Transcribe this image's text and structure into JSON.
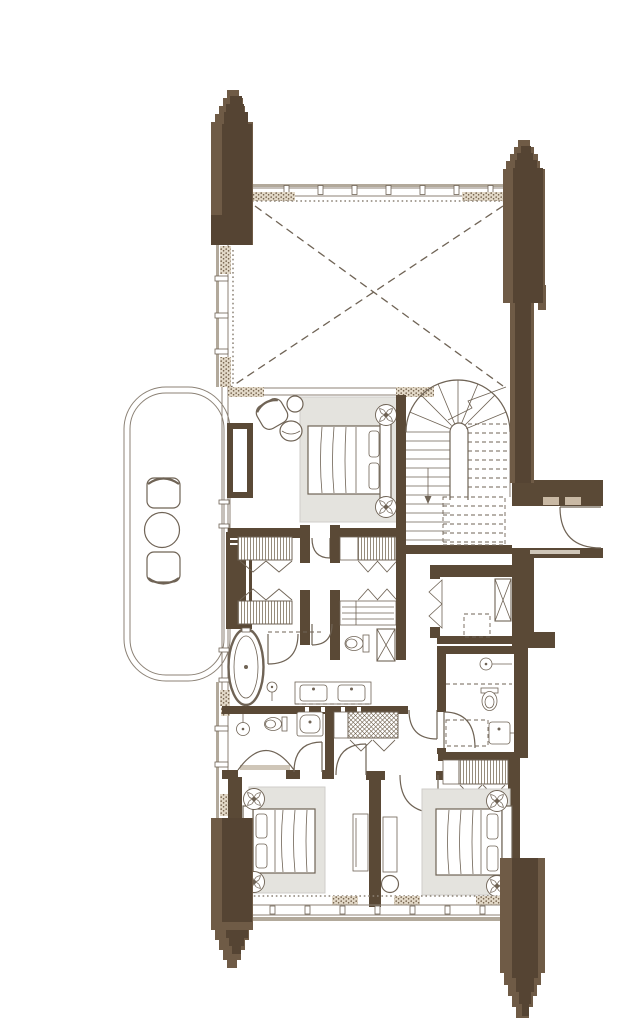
{
  "page": {
    "background": "#ffffff",
    "description": "Architectural floor plan of a residential unit drawn in brown line-work on white; no text labels are rendered on the drawing"
  },
  "colors": {
    "wall": "#5a4936",
    "column_light": "#6f5b46",
    "column_dark": "#554433",
    "line": "#6f6355",
    "line_light": "#8c8276",
    "window_band": "#b2a99b",
    "rug": "#e4e3de",
    "rug_edge": "#cfcec9",
    "inset_light": "#cfc6b8",
    "tick_tan": "#c9b9a4"
  },
  "plan": {
    "columns": [
      "stepped-pylon-top-left",
      "stepped-pylon-top-right",
      "stepped-pylon-bottom-left",
      "stepped-pylon-bottom-right"
    ],
    "rooms": [
      {
        "name": "double-height-void",
        "features": [
          "dashed-cross-diagonals",
          "curtain-wall-glazing"
        ]
      },
      {
        "name": "balcony",
        "features": [
          "lounge-chair",
          "round-table",
          "lounge-chair"
        ]
      },
      {
        "name": "master-bedroom",
        "features": [
          "double-bed",
          "area-rug",
          "flower-side-table",
          "flower-side-table",
          "armchair",
          "ottoman",
          "side-table",
          "tv-console",
          "tall-wardrobe"
        ]
      },
      {
        "name": "staircase",
        "features": [
          "u-stair-with-winders",
          "up-arrow",
          "section-break-line",
          "dashed-upper-flight"
        ]
      },
      {
        "name": "entry-hall",
        "features": [
          "entry-door-swing"
        ]
      },
      {
        "name": "walk-in-closet",
        "features": [
          "hanging-wardrobe",
          "hanging-wardrobe",
          "hanging-wardrobe",
          "shelf-unit"
        ]
      },
      {
        "name": "master-bathroom",
        "features": [
          "freestanding-bathtub",
          "shower-enclosure",
          "hand-shower",
          "double-vanity",
          "toilet",
          "service-shaft"
        ]
      },
      {
        "name": "bathroom-2",
        "features": [
          "curved-shower",
          "shower-head",
          "toilet",
          "vanity-sink"
        ]
      },
      {
        "name": "laundry-closet",
        "features": [
          "bifold-door",
          "appliance-dashed",
          "service-shaft"
        ]
      },
      {
        "name": "inner-lobby",
        "features": [
          "luggage-rack",
          "door-swing",
          "door-swing",
          "door-swing"
        ]
      },
      {
        "name": "bedroom-2",
        "features": [
          "double-bed",
          "area-rug",
          "flower-side-table",
          "flower-side-table",
          "desk"
        ]
      },
      {
        "name": "bedroom-3",
        "features": [
          "double-bed",
          "area-rug",
          "flower-side-table",
          "flower-side-table",
          "desk",
          "chair",
          "hanging-wardrobe"
        ]
      },
      {
        "name": "bathroom-3",
        "features": [
          "shower",
          "toilet",
          "vanity-sink",
          "door-swing"
        ]
      }
    ],
    "symbols": {
      "door_swing": "quarter-circle arc with leaf line",
      "void_marker": "dashed X diagonals",
      "wardrobe_rail": "fine vertical hatching with chevron brackets",
      "window_wall": "double line with mullion posts and thick outer band",
      "masonry_fill": "speckled hatch",
      "structural_column": "two-tone stepped pylon"
    }
  }
}
